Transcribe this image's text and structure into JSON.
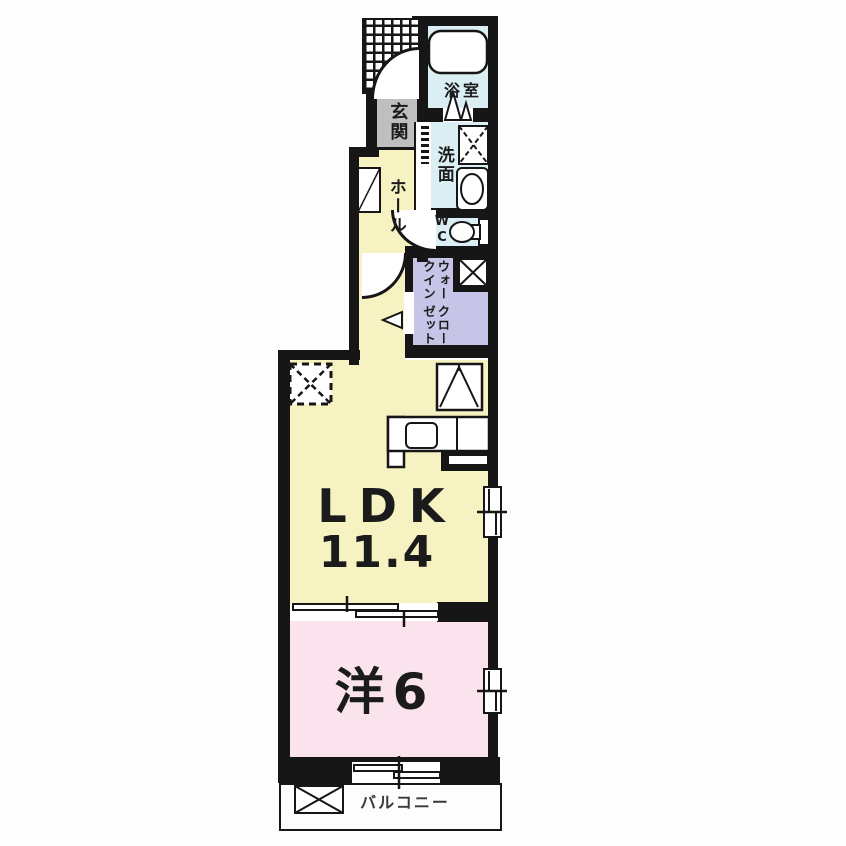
{
  "plan": {
    "rooms": {
      "entrance": {
        "label": "玄関"
      },
      "bathroom": {
        "label": "浴室"
      },
      "washroom": {
        "label": "洗面"
      },
      "toilet": {
        "label": "WC"
      },
      "hall": {
        "label": "ホール"
      },
      "walk_in_closet": {
        "label_line1": "ウォークイン",
        "label_line2": "クローゼット"
      },
      "ldk": {
        "label": "LDK",
        "area": "11.4"
      },
      "western_room": {
        "label": "洋6"
      },
      "balcony": {
        "label": "バルコニー"
      }
    },
    "colors": {
      "wall": "#161616",
      "ldk": "#f6f2c2",
      "bedroom": "#fae3ed",
      "closet": "#c7c5e7",
      "wet": "#daeef3",
      "entrance": "#bfbfbf",
      "text": "#1b1b1b"
    }
  }
}
